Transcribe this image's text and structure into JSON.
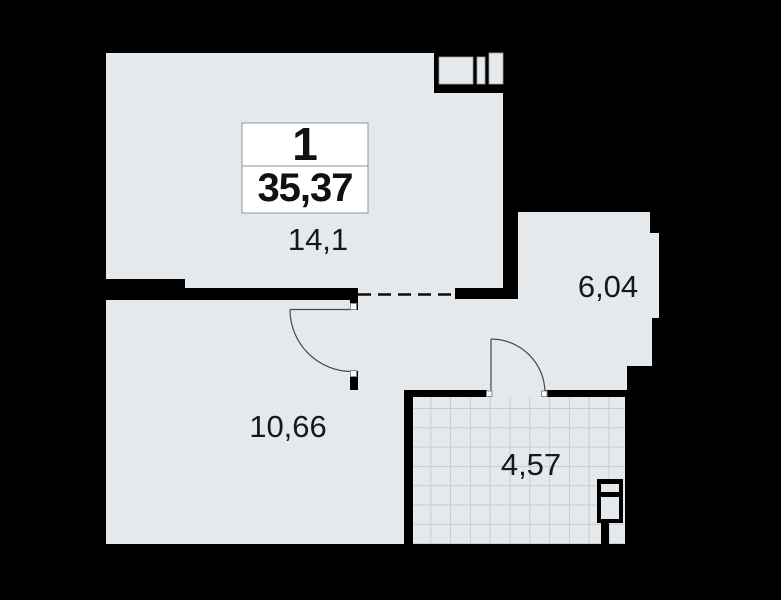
{
  "title": "apartment-floor-plan",
  "unit_card": {
    "rooms_count": "1",
    "total_area": "35,37"
  },
  "rooms": [
    {
      "id": "living-room",
      "area_label": "14,1"
    },
    {
      "id": "hallway",
      "area_label": "6,04"
    },
    {
      "id": "kitchen-room",
      "area_label": "10,66"
    },
    {
      "id": "bathroom",
      "area_label": "4,57"
    }
  ],
  "icons": {
    "vent_shaft": "vent-shaft-icon",
    "plumbing_shaft": "plumbing-shaft-icon",
    "doors": "door-swing-arc",
    "opening": "dashed-opening-line"
  },
  "colors": {
    "background": "#000000",
    "floor": "#e6e9ec",
    "walls": "#000000",
    "tile_grid": "#c7ccd1",
    "unit_card_bg": "#ffffff",
    "unit_card_border": "#8f9499",
    "label_text": "#17181a"
  }
}
